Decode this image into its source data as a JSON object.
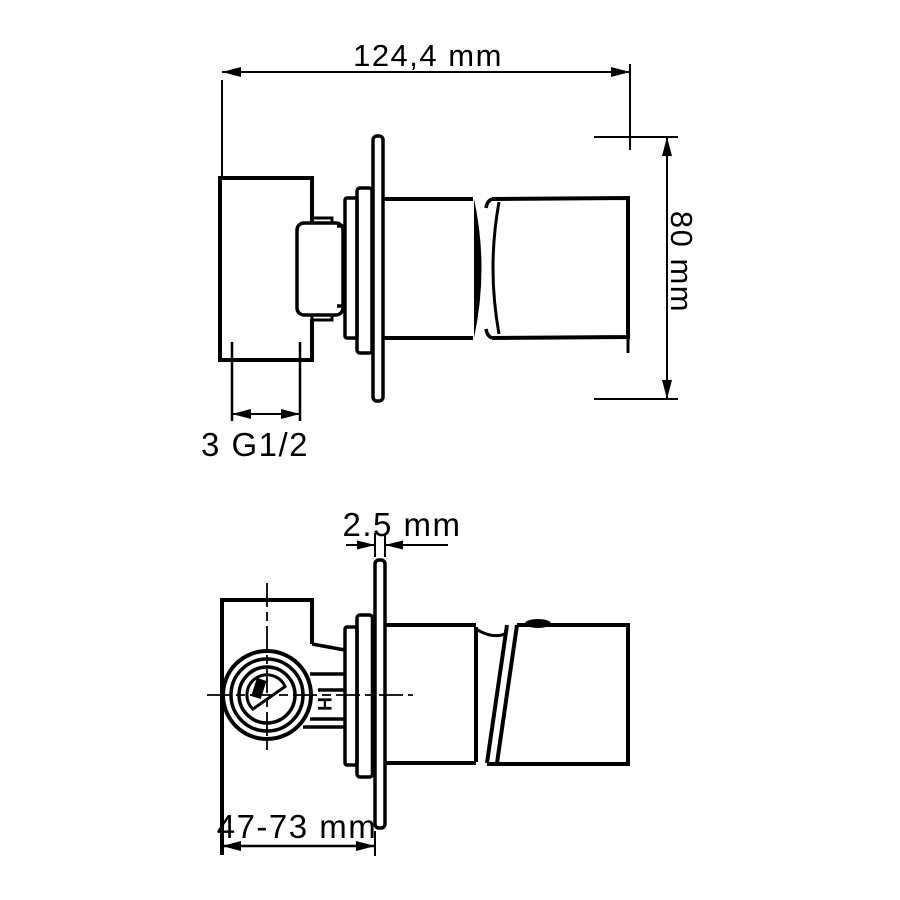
{
  "views": {
    "side": {
      "width_label": "124,4 mm",
      "height_label": "80 mm",
      "thread_label": "3 G1/2"
    },
    "section": {
      "plate_thickness_label": "2.5 mm",
      "mounting_depth_label": "47-73 mm",
      "hot_marking": "H"
    }
  },
  "colors": {
    "line": "#000000",
    "background": "#ffffff"
  }
}
